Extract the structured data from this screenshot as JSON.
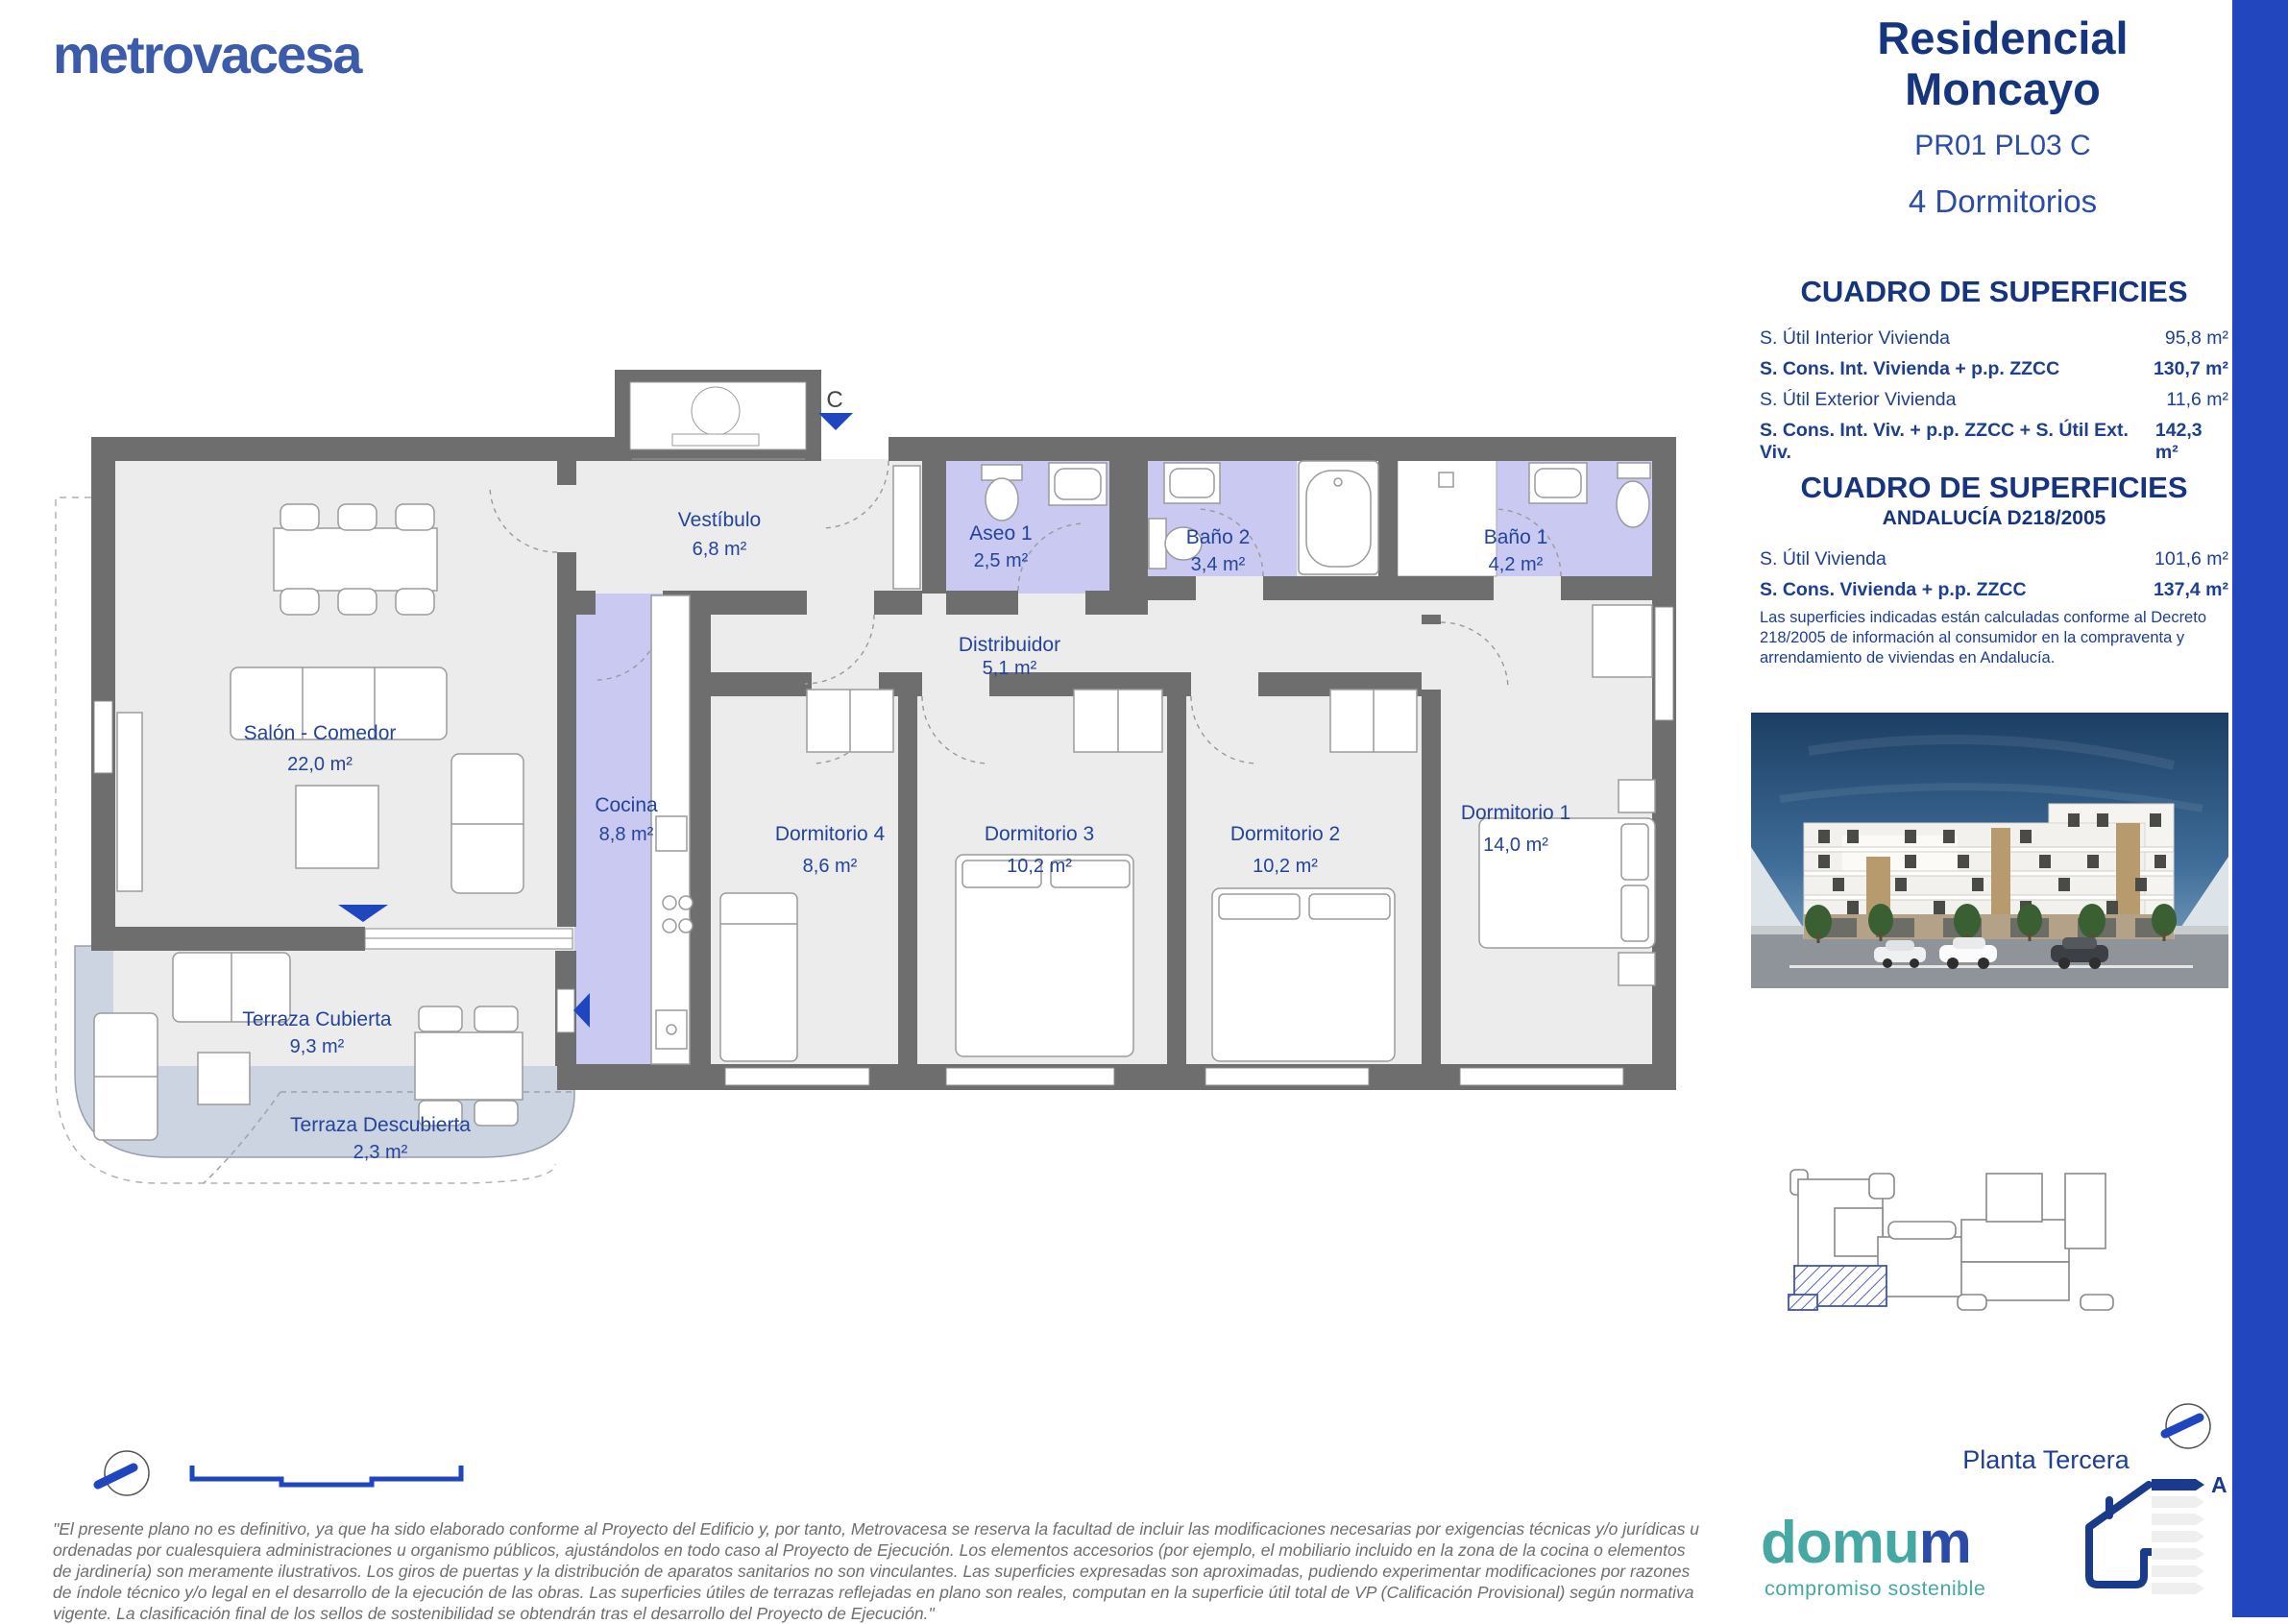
{
  "brand": {
    "logo": "metrovacesa"
  },
  "header": {
    "title_line1": "Residencial",
    "title_line2": "Moncayo",
    "code": "PR01 PL03 C",
    "subtitle": "4 Dormitorios"
  },
  "surface_table_1": {
    "title": "CUADRO DE SUPERFICIES",
    "rows": [
      {
        "label": "S. Útil Interior Vivienda",
        "value": "95,8 m²",
        "bold": false
      },
      {
        "label": "S. Cons. Int. Vivienda + p.p. ZZCC",
        "value": "130,7 m²",
        "bold": true
      },
      {
        "label": "S. Útil Exterior Vivienda",
        "value": "11,6 m²",
        "bold": false
      },
      {
        "label": "S. Cons. Int. Viv. + p.p. ZZCC + S. Útil Ext. Viv.",
        "value": "142,3 m²",
        "bold": true
      }
    ]
  },
  "surface_table_2": {
    "title": "CUADRO DE SUPERFICIES",
    "subtitle": "ANDALUCÍA D218/2005",
    "rows": [
      {
        "label": "S. Útil Vivienda",
        "value": "101,6 m²",
        "bold": false
      },
      {
        "label": "S. Cons. Vivienda + p.p. ZZCC",
        "value": "137,4 m²",
        "bold": true
      }
    ],
    "note": "Las superficies indicadas están calculadas conforme al Decreto 218/2005 de información al consumidor en la compraventa y arrendamiento de viviendas en Andalucía."
  },
  "plan": {
    "entrance_letter": "C",
    "rooms": {
      "salon": {
        "label": "Salón - Comedor",
        "area": "22,0 m²"
      },
      "cocina": {
        "label": "Cocina",
        "area": "8,8 m²"
      },
      "vestibulo": {
        "label": "Vestíbulo",
        "area": "6,8 m²"
      },
      "aseo1": {
        "label": "Aseo 1",
        "area": "2,5 m²"
      },
      "distribuidor": {
        "label": "Distribuidor",
        "area": "5,1 m²"
      },
      "bano2": {
        "label": "Baño 2",
        "area": "3,4 m²"
      },
      "bano1": {
        "label": "Baño 1",
        "area": "4,2 m²"
      },
      "dorm4": {
        "label": "Dormitorio 4",
        "area": "8,6 m²"
      },
      "dorm3": {
        "label": "Dormitorio 3",
        "area": "10,2 m²"
      },
      "dorm2": {
        "label": "Dormitorio 2",
        "area": "10,2 m²"
      },
      "dorm1": {
        "label": "Dormitorio 1",
        "area": "14,0 m²"
      },
      "terraza_cubierta": {
        "label": "Terraza Cubierta",
        "area": "9,3 m²"
      },
      "terraza_descubierta": {
        "label": "Terraza Descubierta",
        "area": "2,3 m²"
      }
    }
  },
  "keyplan": {
    "caption": "Planta Tercera"
  },
  "energy": {
    "rating": "A"
  },
  "domum": {
    "name_teal": "domu",
    "name_blue": "m",
    "tagline": "compromiso sostenible"
  },
  "footer": {
    "disclaimer": "\"El presente plano no es definitivo, ya que ha sido elaborado conforme al Proyecto del Edificio y, por tanto, Metrovacesa se reserva la facultad de incluir las modificaciones necesarias por exigencias técnicas y/o jurídicas u ordenadas por cualesquiera administraciones u organismo públicos, ajustándolos en todo caso al Proyecto de Ejecución. Los elementos accesorios (por ejemplo, el mobiliario incluido en la zona de la cocina o elementos de jardinería) son meramente ilustrativos. Los giros de puertas y la distribución de aparatos sanitarios no son vinculantes. Las superficies expresadas son aproximadas, pudiendo experimentar modificaciones por razones de índole técnico y/o legal en el desarrollo de la ejecución de las obras. Las superficies útiles de terrazas reflejadas en plano son reales, computan en la superficie útil total de VP (Calificación Provisional) según normativa vigente. La clasificación final de los sellos de sostenibilidad se obtendrán tras el desarrollo del Proyecto de Ejecución.\""
  },
  "colors": {
    "brand_blue": "#3d5bab",
    "navy": "#1a3a8c",
    "accent_blue": "#1f46be",
    "page_edge_blue": "#2246be",
    "wall_gray": "#6e6e6e",
    "floor_gray": "#ececec",
    "wet_room_lavender": "#c9c9f1",
    "terrace_blue_gray": "#ccd3e1",
    "domum_teal": "#45a8a3",
    "disclaimer_gray": "#6e6e6e"
  }
}
